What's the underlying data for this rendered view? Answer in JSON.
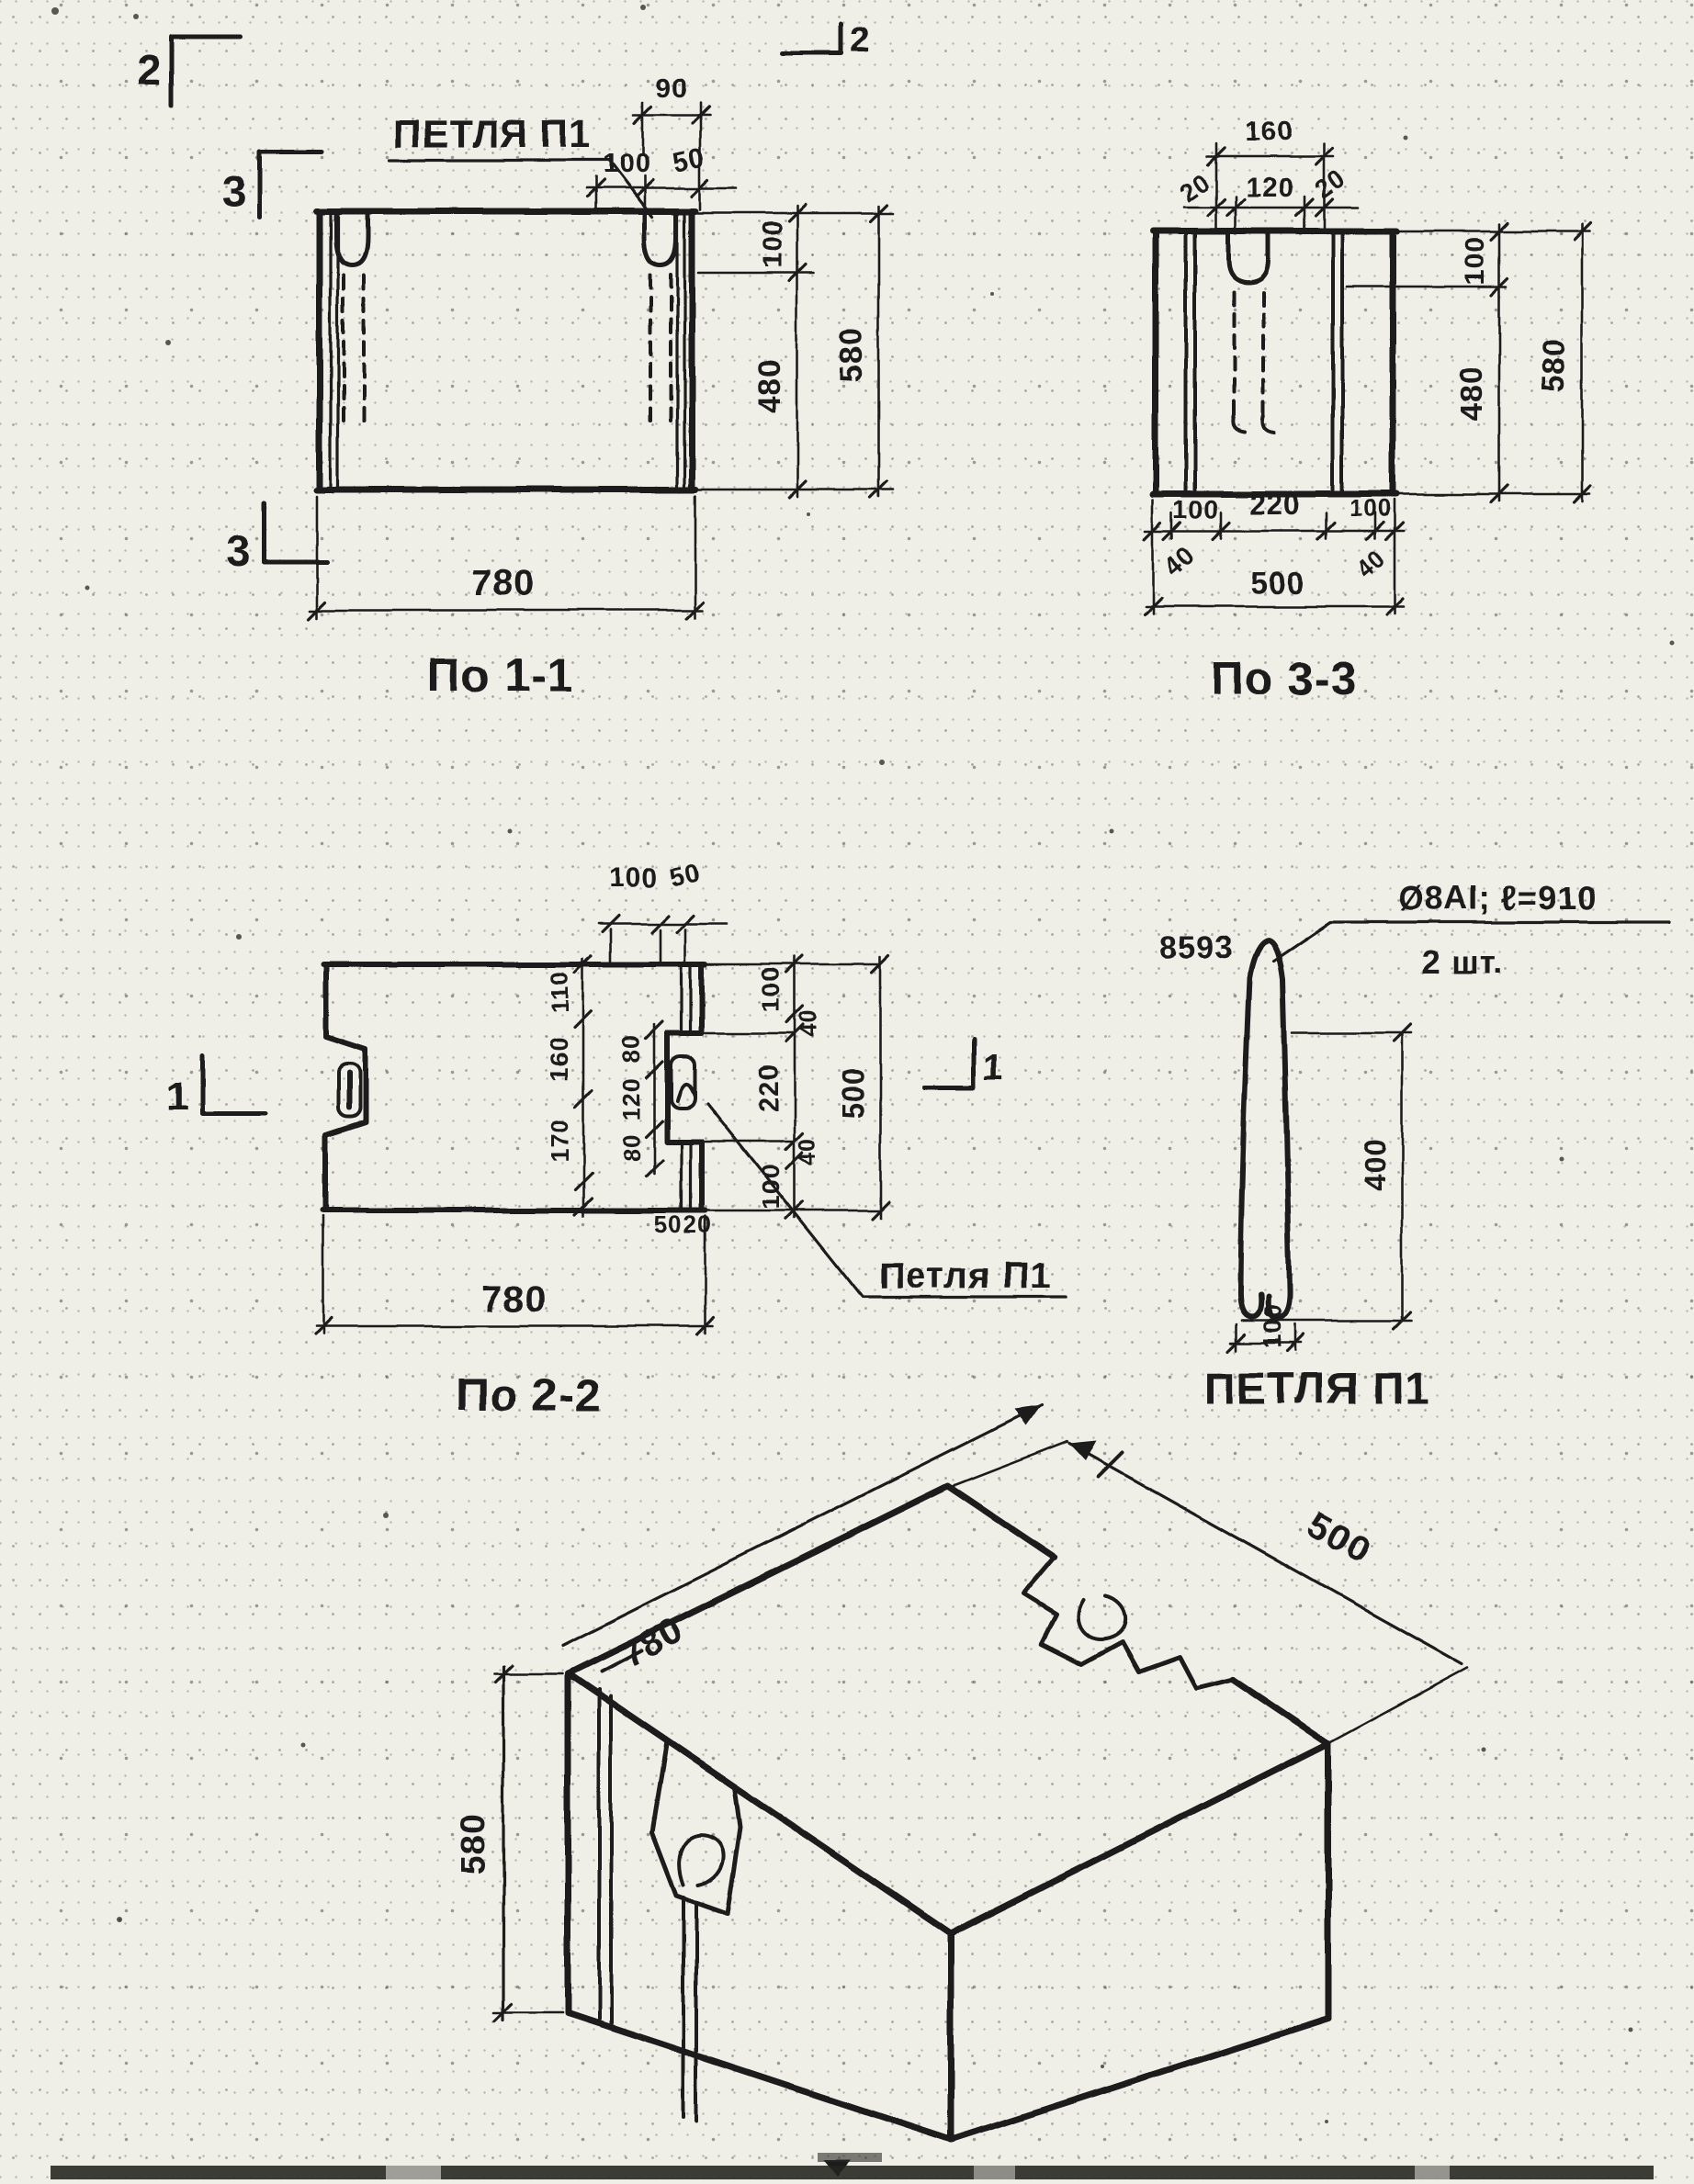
{
  "paper_color": "#efeee7",
  "ink_color": "#1d1d1c",
  "section_1_1": {
    "caption": "По 1-1",
    "loop_label": "ПЕТЛЯ П1",
    "marker_2": "2",
    "marker_3": "3",
    "dims": {
      "top_90": "90",
      "top_100": "100",
      "top_50": "50",
      "right_100": "100",
      "right_480": "480",
      "right_580": "580",
      "bottom_780": "780"
    }
  },
  "section_3_3": {
    "caption": "По 3-3",
    "dims": {
      "top_160": "160",
      "top_20_left": "20",
      "top_120": "120",
      "top_20_right": "20",
      "right_100": "100",
      "right_480": "480",
      "right_580": "580",
      "bottom_100_left": "100",
      "bottom_220": "220",
      "bottom_100_right": "100",
      "bottom_40_left": "40",
      "bottom_40_right": "40",
      "bottom_500": "500"
    }
  },
  "section_2_2": {
    "caption": "По 2-2",
    "loop_label": "Петля П1",
    "marker_1": "1",
    "dims": {
      "top_100": "100",
      "top_50": "50",
      "left_col": [
        "110",
        "160",
        "170"
      ],
      "mid_col": [
        "80",
        "120",
        "80"
      ],
      "small_50": "50",
      "small_20": "20",
      "right_chain": [
        "100",
        "40",
        "220",
        "40",
        "100"
      ],
      "right_500": "500",
      "bottom_780": "780"
    }
  },
  "loop_detail": {
    "caption": "ПЕТЛЯ П1",
    "mark": "8593",
    "note_spec": "Ø8АI; ℓ=910",
    "note_qty": "2 шт.",
    "dims": {
      "height_400": "400",
      "width_100": "100"
    }
  },
  "isometric": {
    "dims": {
      "length_780": "780",
      "width_500": "500",
      "height_580": "580"
    }
  }
}
